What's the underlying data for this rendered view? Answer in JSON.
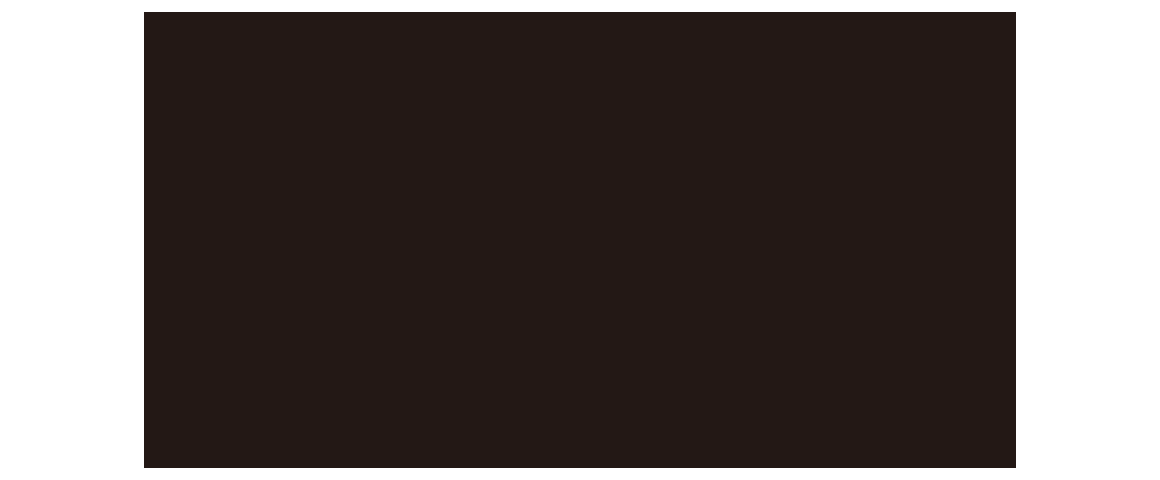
{
  "canvas": {
    "background_color": "#ffffff"
  },
  "panel": {
    "background_color": "#231815"
  }
}
